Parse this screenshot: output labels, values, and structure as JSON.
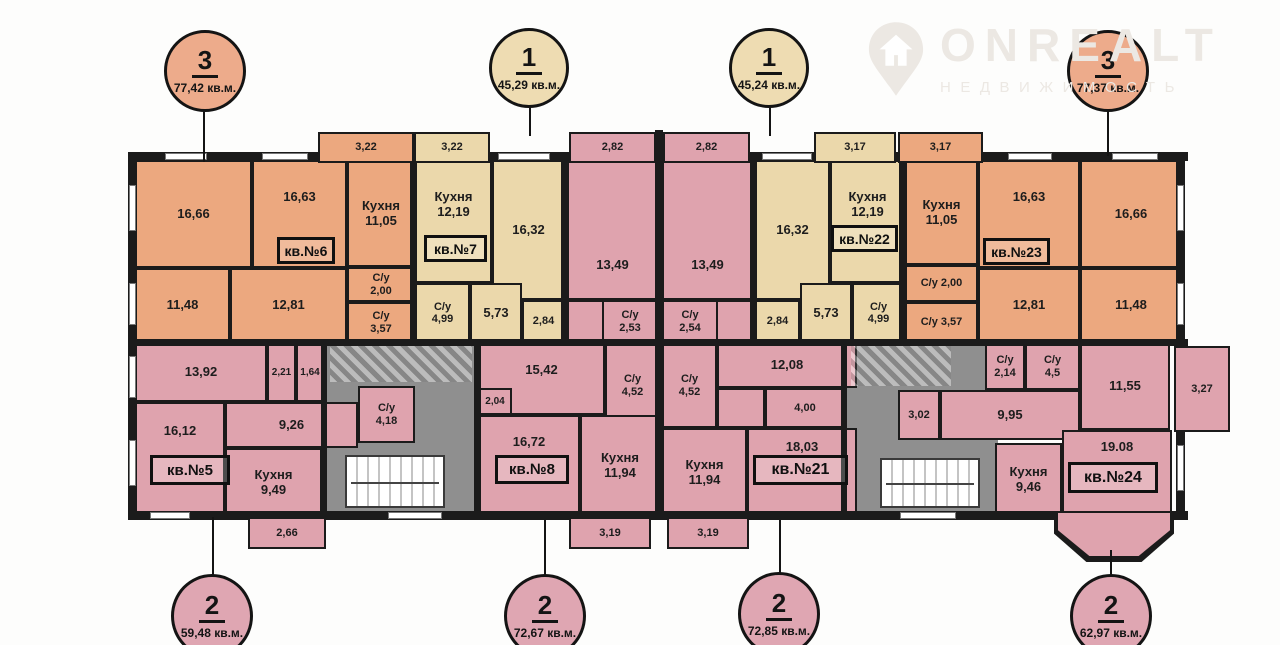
{
  "watermark": {
    "brand": "ONREALT",
    "subtitle": "НЕДВИЖИМОСТЬ"
  },
  "badges": {
    "top": [
      {
        "rooms": "3",
        "area": "77,42 кв.м."
      },
      {
        "rooms": "1",
        "area": "45,29 кв.м."
      },
      {
        "rooms": "1",
        "area": "45,24 кв.м."
      },
      {
        "rooms": "3",
        "area": "77,37 кв.м."
      }
    ],
    "bottom": [
      {
        "rooms": "2",
        "area": "59,48 кв.м."
      },
      {
        "rooms": "2",
        "area": "72,67 кв.м."
      },
      {
        "rooms": "2",
        "area": "72,85 кв.м."
      },
      {
        "rooms": "2",
        "area": "62,97 кв.м."
      }
    ]
  },
  "plan": {
    "apt5": {
      "num": "кв.№5",
      "r_13_92": "13,92",
      "r_2_21": "2,21",
      "r_1_64": "1,64",
      "r_9_26": "9,26",
      "su_label": "С/у",
      "su_area": "4,18",
      "r_16_12": "16,12",
      "kitchen_label": "Кухня",
      "kitchen_area": "9,49",
      "balcony": "2,66"
    },
    "apt6": {
      "num": "кв.№6",
      "r_16_66": "16,66",
      "r_16_63": "16,63",
      "kitchen_label": "Кухня",
      "kitchen_area": "11,05",
      "r_11_48": "11,48",
      "r_12_81": "12,81",
      "su1_label": "С/у",
      "su1_area": "2,00",
      "su2_label": "С/у",
      "su2_area": "3,57",
      "balcony": "3,22"
    },
    "apt7": {
      "num": "кв.№7",
      "kitchen_label": "Кухня",
      "kitchen_area": "12,19",
      "r_16_32": "16,32",
      "su_label": "С/у",
      "su_area": "4,99",
      "r_5_73": "5,73",
      "r_2_84": "2,84",
      "balcony": "3,22"
    },
    "apt8": {
      "num": "кв.№8",
      "balcony_top": "2,82",
      "r_13_49": "13,49",
      "su1_label": "С/у",
      "su1_area": "2,53",
      "su2_label": "С/у",
      "su2_area": "4,52",
      "r_15_42": "15,42",
      "r_2_04": "2,04",
      "r_16_72": "16,72",
      "kitchen_label": "Кухня",
      "kitchen_area": "11,94",
      "balcony_bottom": "3,19"
    },
    "apt21": {
      "num": "кв.№21",
      "balcony_top": "2,82",
      "r_13_49": "13,49",
      "su1_label": "С/у",
      "su1_area": "2,54",
      "su2_label": "С/у",
      "su2_area": "4,52",
      "r_12_08": "12,08",
      "r_4_00": "4,00",
      "r_18_03": "18,03",
      "kitchen_label": "Кухня",
      "kitchen_area": "11,94",
      "balcony_bottom": "3,19"
    },
    "apt22": {
      "num": "кв.№22",
      "kitchen_label": "Кухня",
      "kitchen_area": "12,19",
      "r_16_32": "16,32",
      "su_label": "С/у",
      "su_area": "4,99",
      "r_5_73": "5,73",
      "r_2_84": "2,84",
      "balcony": "3,17"
    },
    "apt23": {
      "num": "кв.№23",
      "kitchen_label": "Кухня",
      "kitchen_area": "11,05",
      "r_16_63": "16,63",
      "r_16_66": "16,66",
      "su1": "С/у 2,00",
      "su2": "С/у 3,57",
      "r_12_81": "12,81",
      "r_11_48": "11,48",
      "balcony": "3,17"
    },
    "apt24": {
      "num": "кв.№24",
      "su1_label": "С/у",
      "su1_area": "2,14",
      "su2_label": "С/у",
      "su2_area": "4,5",
      "r_11_55": "11,55",
      "r_3_02": "3,02",
      "r_9_95": "9,95",
      "kitchen_label": "Кухня",
      "kitchen_area": "9,46",
      "r_19_08": "19.08",
      "balcony_right": "3,27"
    }
  },
  "colors": {
    "three_room": "#eca87f",
    "one_room": "#ebd8ab",
    "two_room": "#dfa3ae",
    "corridor": "#8f8f8f",
    "wall": "#1b1b1b"
  }
}
